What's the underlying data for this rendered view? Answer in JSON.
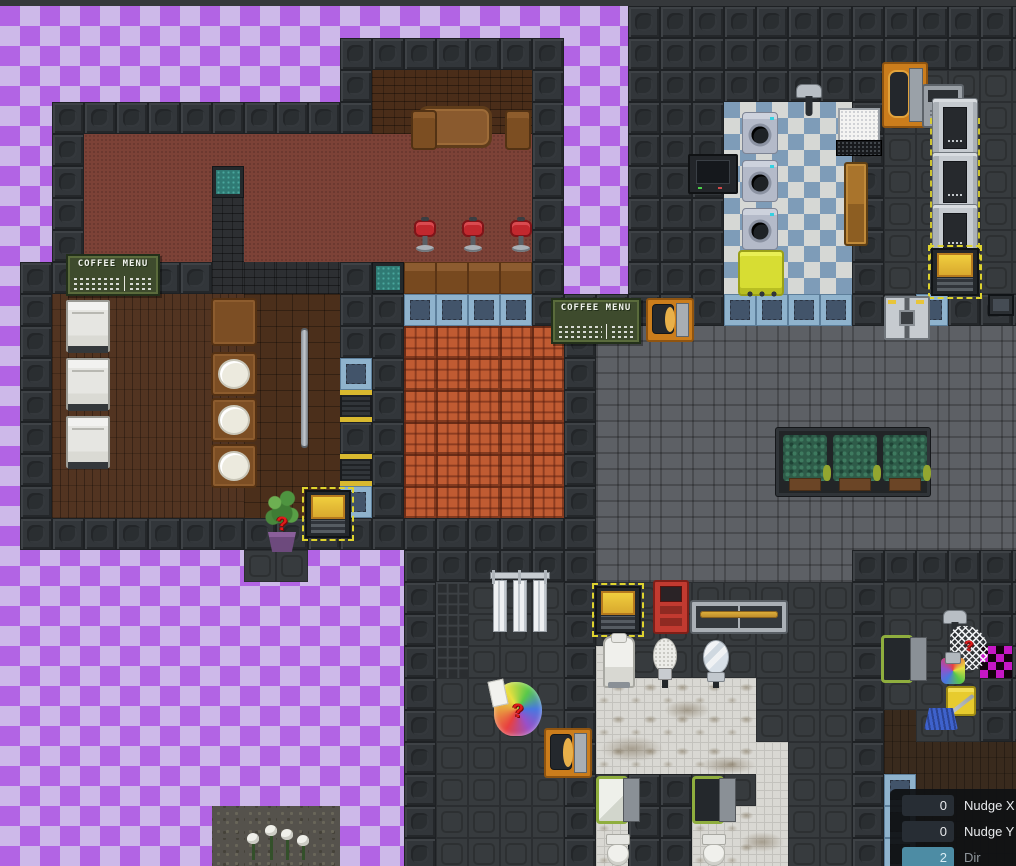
{
  "scene": {
    "tile": 32,
    "origin_x": -12,
    "origin_y": 6,
    "legend": {
      ".": "empty",
      "W": "wall",
      "F": "floor-dark",
      "G": "floor-brick",
      "C": "carpet-red",
      "b": "wall-brown-brick",
      "B": "wall-dark-brick",
      "w": "floor-planks",
      "p": "floor-parquet",
      "n": "bar-counter",
      "R": "floor-quarry",
      "Q": "window-stained",
      "V": "window-reinforced",
      "Y": "shutter",
      "K": "floor-checker-laundry",
      "T": "floor-white-tile",
      "t": "floor-white-tile-dirty",
      "g": "floor-grid",
      "A": "asteroid-rock",
      "D": "floor-dark-planks",
      "X": "missing-texture"
    },
    "rows": [
      "....................WWWWWWWWWWWWW",
      "...........WWWWWWW..WWWWWWWWWWWWW",
      "...........WbbbbbW..WWWWWWWWWFFFF",
      "..WWWWWWWWWWbbbbbW..WWWKKKKWFFFFF",
      "..WCCCCCCCCCCCCCCW..WWWKKKKWFFFFF",
      "..WCCCCQCCCCCCCCCW..WWWKKKKWFFFFF",
      "..WCCCCBCCCCCCCCCW..WWWKKKKWFFFFF",
      "..WCCCCBCCCCCCCCCW..WWWKKKKWFFFFF",
      ".WWWWWWBBBBWQnnnnW..WWWKKKKWFFFFF",
      ".WwwwwwwpppWWVVVVWWWWWWVVVVWWVWWW",
      ".WwwwwwwpppWWRRRRRWGGGGGGGGGGGGGG",
      ".WwwwwwwpppVWRRRRRWGGGGGGGGGGGGGG",
      ".WwwwwwwpppYWRRRRRWGGGGGGGGGGGGGG",
      ".WwwwwwwpppWWRRRRRWGGGGGGGGGGGGGG",
      ".WwwwwwwpppYWRRRRRWGGGGGGGGGGGGGG",
      ".WwwwwwwpppVWRRRRRWGGGGGGGGGGGGGG",
      ".WWWWWWWWWWWWWWWWWWGGGGGGGGGGGGGG",
      "........FF...WWWWWWGGGGGGGGWWWWWW",
      ".............WgFFFWFFFFFFFFWFFFWW",
      ".............WgFFFWFFFFFFFFWFFFWW",
      ".............WgFFFWTFFFFFFFWFFFXW",
      ".............WFFFFWtttttFFFWFFFWW",
      ".............WFFFFWtttttFFFWDFFWW",
      ".............WFFFFWtttttTFFWDDDDD",
      ".............WFFFFWFWWFFTFFWVDDDD",
      ".......AAAA..WFFFFWtWWttTFFWVDDDD",
      ".......AAAA..WFFFFWtWWttTFFWVDDDD"
    ],
    "names": {
      "coffee-sign": "coffee-menu-sign",
      "fridge": "fridge",
      "wood-table": "wooden-table",
      "chair-wood": "wooden-chair",
      "stool-red": "bar-stool",
      "table-brown": "bar-table",
      "table-plate": "table-with-plate",
      "pole": "railing-pole",
      "plant-q": "random-plant-spawner",
      "vend-yellow": "yellow-vending-machine",
      "spawn-rainbow": "random-item-spawner",
      "door-orange-v": "airlock-door",
      "door-orange-h": "airlock-door",
      "washer": "washing-machine",
      "cart-yellow": "laundry-cart",
      "tv": "wall-television",
      "computer": "computer-terminal",
      "bench-wood": "wooden-bench",
      "machine-gray": "arcade-machine",
      "shower-head": "shower-head",
      "dash-zone": "delivery-zone-marking",
      "locker": "locker",
      "door-double": "double-door",
      "panel-screen": "wall-display",
      "planter": "hedge-planter",
      "vend-red": "red-vending-machine",
      "counter-brass": "sink-counter",
      "cooler": "water-cooler",
      "urinal": "urinal",
      "mirror": "mirror",
      "showers": "shower-stall",
      "stall-door": "toilet-stall-door",
      "door-green": "janitor-door",
      "net-spawn": "random-net-spawner",
      "spawn-rainbow-sm": "random-item-spawner",
      "mop-bucket": "mop-and-bucket",
      "toilet": "toilet",
      "flowers": "white-flowers",
      "stain": "floor-stain"
    },
    "objects": [
      {
        "t": "coffee-sign",
        "x": 66,
        "y": 254,
        "w": 94,
        "h": 42
      },
      {
        "t": "coffee-sign",
        "x": 551,
        "y": 298,
        "w": 90,
        "h": 46
      },
      {
        "t": "fridge",
        "x": 66,
        "y": 300,
        "w": 44,
        "h": 52
      },
      {
        "t": "fridge",
        "x": 66,
        "y": 358,
        "w": 44,
        "h": 52
      },
      {
        "t": "fridge",
        "x": 66,
        "y": 416,
        "w": 44,
        "h": 52
      },
      {
        "t": "wood-table",
        "x": 418,
        "y": 106,
        "w": 74,
        "h": 42
      },
      {
        "t": "chair-wood",
        "x": 411,
        "y": 110,
        "w": 26,
        "h": 40
      },
      {
        "t": "chair-wood",
        "x": 505,
        "y": 110,
        "w": 26,
        "h": 40
      },
      {
        "t": "stool-red",
        "x": 414,
        "y": 216,
        "w": 22,
        "h": 36
      },
      {
        "t": "stool-red",
        "x": 462,
        "y": 216,
        "w": 22,
        "h": 36
      },
      {
        "t": "stool-red",
        "x": 510,
        "y": 216,
        "w": 22,
        "h": 36
      },
      {
        "t": "table-brown",
        "x": 211,
        "y": 298,
        "w": 46,
        "h": 48
      },
      {
        "t": "table-plate",
        "x": 211,
        "y": 352,
        "w": 46,
        "h": 44
      },
      {
        "t": "table-plate",
        "x": 211,
        "y": 398,
        "w": 46,
        "h": 44
      },
      {
        "t": "table-plate",
        "x": 211,
        "y": 444,
        "w": 46,
        "h": 44
      },
      {
        "t": "pole",
        "x": 301,
        "y": 330,
        "w": 7,
        "h": 116
      },
      {
        "t": "plant-q",
        "x": 262,
        "y": 490,
        "w": 40,
        "h": 64
      },
      {
        "t": "vend-yellow",
        "x": 305,
        "y": 490,
        "w": 46,
        "h": 48
      },
      {
        "t": "spawn-rainbow",
        "x": 494,
        "y": 682,
        "w": 48,
        "h": 54
      },
      {
        "t": "door-orange-v",
        "x": 882,
        "y": 62,
        "w": 46,
        "h": 66
      },
      {
        "t": "door-orange-h",
        "x": 646,
        "y": 298,
        "w": 48,
        "h": 44
      },
      {
        "t": "door-orange-h",
        "x": 544,
        "y": 728,
        "w": 48,
        "h": 50
      },
      {
        "t": "washer",
        "x": 742,
        "y": 112,
        "w": 36,
        "h": 42
      },
      {
        "t": "washer",
        "x": 742,
        "y": 160,
        "w": 36,
        "h": 42
      },
      {
        "t": "washer",
        "x": 742,
        "y": 208,
        "w": 36,
        "h": 42
      },
      {
        "t": "cart-yellow",
        "x": 738,
        "y": 250,
        "w": 46,
        "h": 46
      },
      {
        "t": "tv",
        "x": 688,
        "y": 154,
        "w": 50,
        "h": 40
      },
      {
        "t": "computer",
        "x": 836,
        "y": 108,
        "w": 46,
        "h": 52
      },
      {
        "t": "bench-wood",
        "x": 844,
        "y": 162,
        "w": 24,
        "h": 84
      },
      {
        "t": "machine-gray",
        "x": 922,
        "y": 84,
        "w": 42,
        "h": 44
      },
      {
        "t": "shower-head",
        "x": 796,
        "y": 80,
        "w": 26,
        "h": 38
      },
      {
        "t": "shower-head",
        "x": 943,
        "y": 606,
        "w": 24,
        "h": 38
      },
      {
        "t": "dash-zone",
        "x": 930,
        "y": 118,
        "w": 50,
        "h": 48
      },
      {
        "t": "dash-zone",
        "x": 930,
        "y": 170,
        "w": 50,
        "h": 48
      },
      {
        "t": "dash-zone",
        "x": 930,
        "y": 222,
        "w": 50,
        "h": 48
      },
      {
        "t": "locker",
        "x": 932,
        "y": 98,
        "w": 46,
        "h": 56
      },
      {
        "t": "locker",
        "x": 932,
        "y": 152,
        "w": 46,
        "h": 56
      },
      {
        "t": "locker",
        "x": 932,
        "y": 204,
        "w": 46,
        "h": 52
      },
      {
        "t": "vend-yellow",
        "x": 931,
        "y": 248,
        "w": 48,
        "h": 48
      },
      {
        "t": "door-double",
        "x": 884,
        "y": 296,
        "w": 46,
        "h": 44
      },
      {
        "t": "panel-screen",
        "x": 988,
        "y": 294,
        "w": 26,
        "h": 22
      },
      {
        "t": "planter",
        "x": 776,
        "y": 428,
        "w": 154,
        "h": 68
      },
      {
        "t": "vend-yellow",
        "x": 595,
        "y": 586,
        "w": 46,
        "h": 48
      },
      {
        "t": "vend-red",
        "x": 653,
        "y": 580,
        "w": 36,
        "h": 54
      },
      {
        "t": "counter-brass",
        "x": 690,
        "y": 600,
        "w": 98,
        "h": 34
      },
      {
        "t": "cooler",
        "x": 603,
        "y": 636,
        "w": 32,
        "h": 52
      },
      {
        "t": "urinal",
        "x": 653,
        "y": 638,
        "w": 24,
        "h": 50
      },
      {
        "t": "mirror",
        "x": 703,
        "y": 640,
        "w": 26,
        "h": 48
      },
      {
        "t": "showers",
        "x": 490,
        "y": 566,
        "w": 60,
        "h": 70
      },
      {
        "t": "stall-door",
        "v": "closed",
        "x": 596,
        "y": 776,
        "w": 44,
        "h": 48
      },
      {
        "t": "stall-door",
        "v": "open",
        "x": 692,
        "y": 776,
        "w": 44,
        "h": 48
      },
      {
        "t": "door-green",
        "v": "open",
        "x": 881,
        "y": 635,
        "w": 46,
        "h": 48
      },
      {
        "t": "net-spawn",
        "x": 950,
        "y": 626,
        "w": 38,
        "h": 44
      },
      {
        "t": "spawn-rainbow-sm",
        "x": 941,
        "y": 658,
        "w": 24,
        "h": 26
      },
      {
        "t": "mop-bucket",
        "x": 924,
        "y": 682,
        "w": 56,
        "h": 50
      },
      {
        "t": "toilet",
        "x": 604,
        "y": 834,
        "w": 28,
        "h": 32
      },
      {
        "t": "toilet",
        "x": 700,
        "y": 834,
        "w": 28,
        "h": 32
      },
      {
        "t": "flowers",
        "x": 242,
        "y": 822,
        "w": 72,
        "h": 44
      },
      {
        "t": "stain",
        "x": 600,
        "y": 736,
        "w": 64,
        "h": 26
      },
      {
        "t": "stain",
        "x": 664,
        "y": 700,
        "w": 46,
        "h": 20
      },
      {
        "t": "stain",
        "x": 700,
        "y": 756,
        "w": 56,
        "h": 18
      },
      {
        "t": "stain",
        "x": 740,
        "y": 832,
        "w": 44,
        "h": 20
      }
    ]
  },
  "signs": {
    "coffee_menu": "COFFEE MENU"
  },
  "icons": {
    "question_mark": "?"
  },
  "colors": {
    "checker_light": "#cdb9e9",
    "checker_dark": "#b264e4",
    "panel_bg": "#17191b",
    "field_bg": "#272d34",
    "dir_field_bg": "#4d8ca4",
    "hazard_yellow": "#ded32e",
    "airlock_orange": "#cb7d1c",
    "carpet_red": "#7c4237",
    "quarry_orange": "#c05b32",
    "window_blue": "#8fb3cd",
    "stall_green": "#8fae3e",
    "missing_texture_magenta": "#c617c6"
  },
  "inspector": {
    "rows": [
      {
        "value": "0",
        "label": "Nudge X"
      },
      {
        "value": "0",
        "label": "Nudge Y"
      },
      {
        "value": "2",
        "label": "Dir"
      }
    ]
  }
}
